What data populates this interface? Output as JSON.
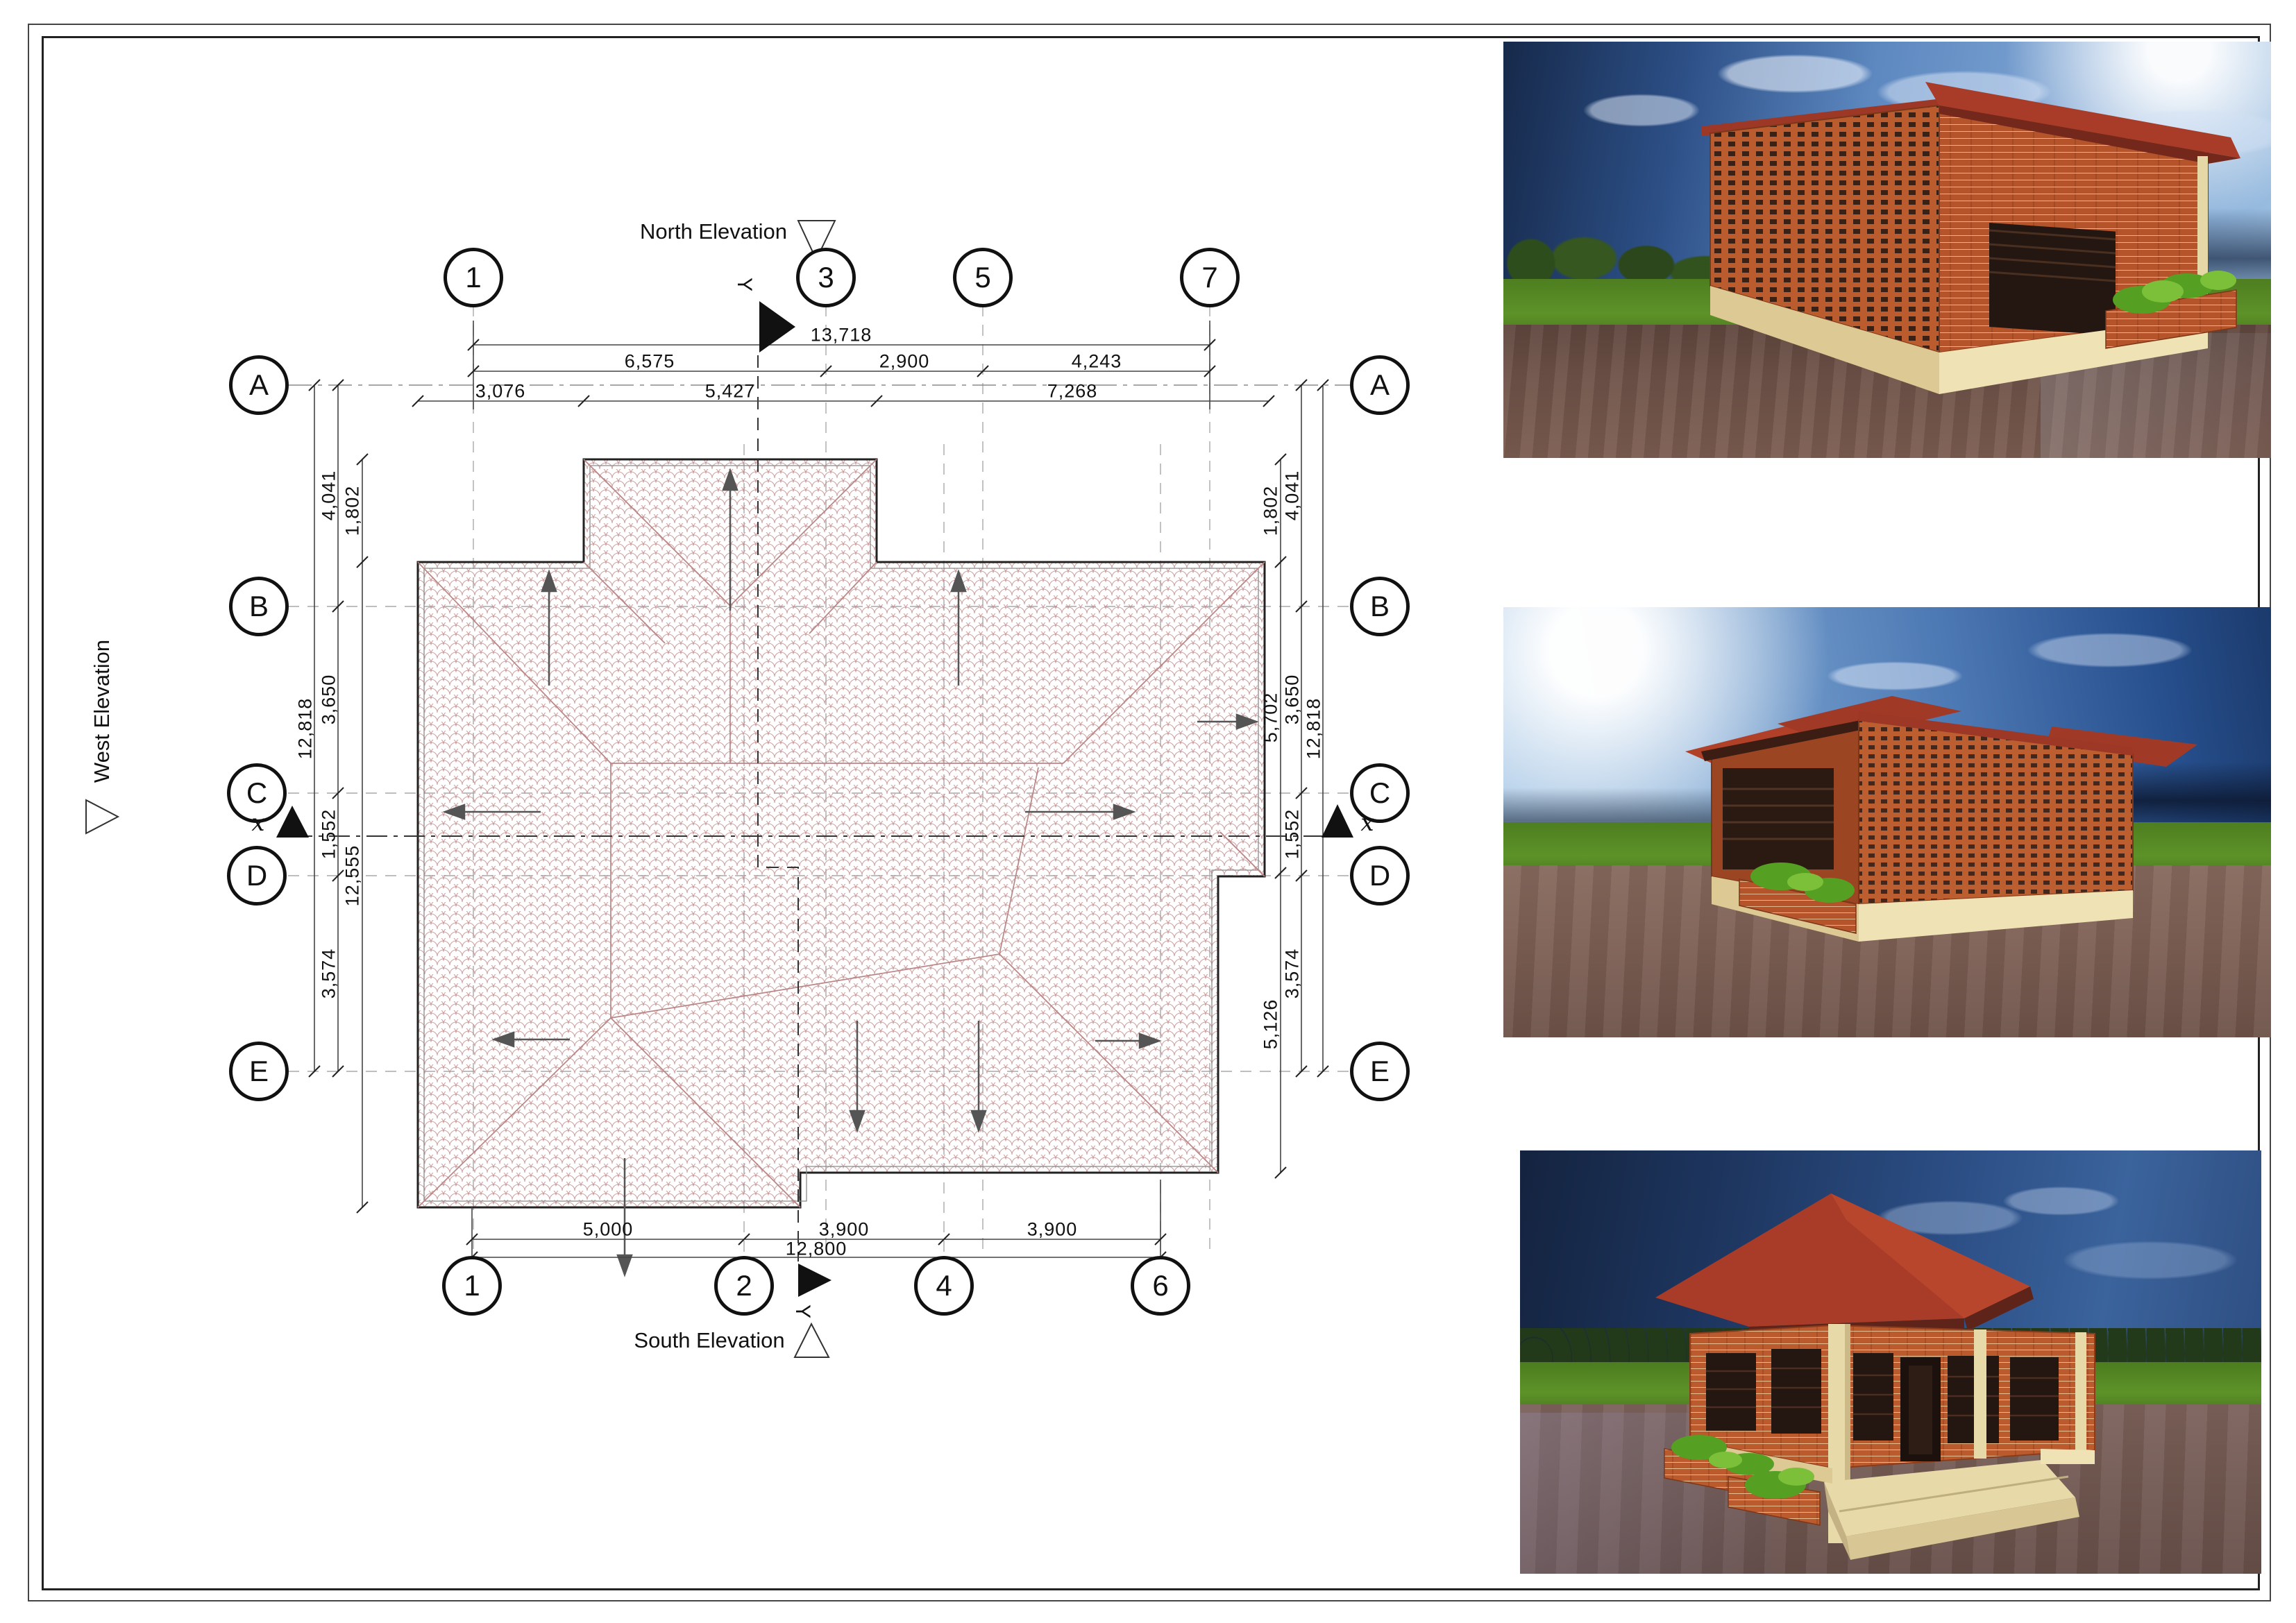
{
  "labels": {
    "north": "North Elevation",
    "south": "South Elevation",
    "west": "West Elevation",
    "section_x": "x",
    "section_y": "Y"
  },
  "grid": {
    "top": [
      "1",
      "3",
      "5",
      "7"
    ],
    "bottom": [
      "1",
      "2",
      "4",
      "6"
    ],
    "left": [
      "A",
      "B",
      "C",
      "D",
      "E"
    ],
    "right": [
      "A",
      "B",
      "C",
      "D",
      "E"
    ]
  },
  "dims": {
    "top": {
      "overall": "13,718",
      "seg": [
        "6,575",
        "2,900",
        "4,243"
      ],
      "edge": [
        "3,076",
        "5,427",
        "7,268"
      ]
    },
    "bottom": {
      "seg": [
        "5,000",
        "3,900",
        "3,900"
      ],
      "overall": "12,800"
    },
    "left": {
      "overall": "12,818",
      "mid": [
        "4,041",
        "3,650",
        "1,552",
        "3,574"
      ],
      "inner": [
        "1,802",
        "12,555"
      ]
    },
    "right": {
      "overall": "12,818",
      "mid": [
        "4,041",
        "3,650",
        "1,552",
        "3,574"
      ],
      "inner": [
        "1,802",
        "5,702",
        "5,126"
      ]
    }
  },
  "renders": [
    {
      "name": "exterior-perspective-lattice-corner"
    },
    {
      "name": "exterior-perspective-rear-corner"
    },
    {
      "name": "exterior-perspective-porch-front"
    }
  ],
  "colors": {
    "brick": "#b9572c",
    "roof": "#a83c28",
    "plinth": "#e8d9a8",
    "hatch": "#c49090",
    "line": "#333333"
  }
}
